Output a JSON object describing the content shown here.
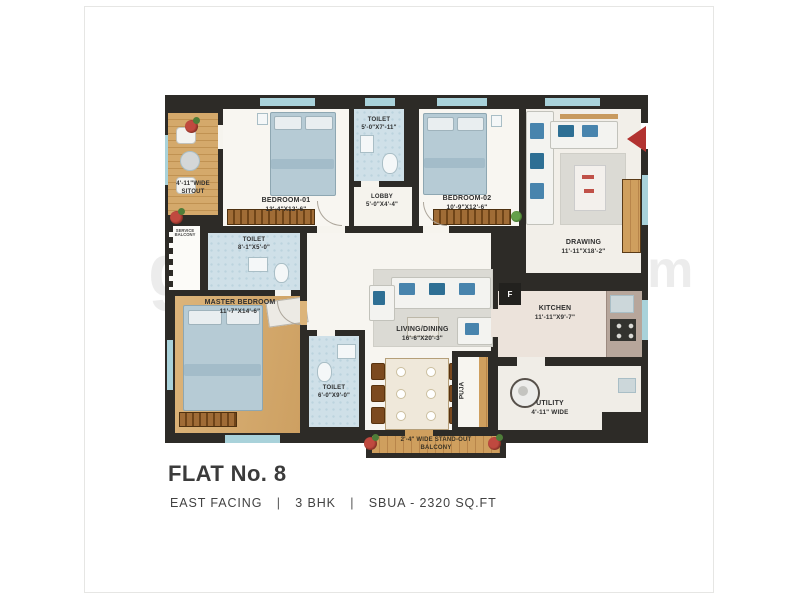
{
  "footer": {
    "flat": "FLAT No. 8",
    "facing": "EAST FACING",
    "bhk": "3 BHK",
    "area": "SBUA - 2320 SQ.FT",
    "sep": "|"
  },
  "rooms": {
    "sitout": {
      "line1": "4'-11\"WIDE",
      "line2": "SITOUT"
    },
    "service_balcony": {
      "line1": "SERVICE",
      "line2": "BALCONY"
    },
    "bedroom01": {
      "name": "BEDROOM-01",
      "dims": "13'-4\"X12'-6\""
    },
    "toilet_top": {
      "name": "TOILET",
      "dims": "5'-0\"X7'-11\""
    },
    "lobby": {
      "name": "LOBBY",
      "dims": "5'-0\"X4'-4\""
    },
    "bedroom02": {
      "name": "BEDROOM-02",
      "dims": "10'-9\"X12'-6\""
    },
    "drawing": {
      "name": "DRAWING",
      "dims": "11'-11\"X18'-2\""
    },
    "toilet_mid": {
      "name": "TOILET",
      "dims": "8'-1\"X5'-0\""
    },
    "master": {
      "name": "MASTER BEDROOM",
      "dims": "11'-7\"X14'-6\""
    },
    "living": {
      "name": "LIVING/DINING",
      "dims": "16'-6\"X20'-3\""
    },
    "toilet_bottom": {
      "name": "TOILET",
      "dims": "6'-0\"X9'-0\""
    },
    "puja": {
      "name": "PUJA"
    },
    "kitchen": {
      "name": "KITCHEN",
      "dims": "11'-11\"X9'-7\"",
      "fridge": "F"
    },
    "utility": {
      "name": "UTILITY",
      "dims": "4'-11\" WIDE"
    },
    "balcony": {
      "line1": "2'-4\" WIDE STAND-OUT",
      "line2": "BALCONY"
    }
  },
  "watermark": {
    "left": "g",
    "right": ".com"
  }
}
